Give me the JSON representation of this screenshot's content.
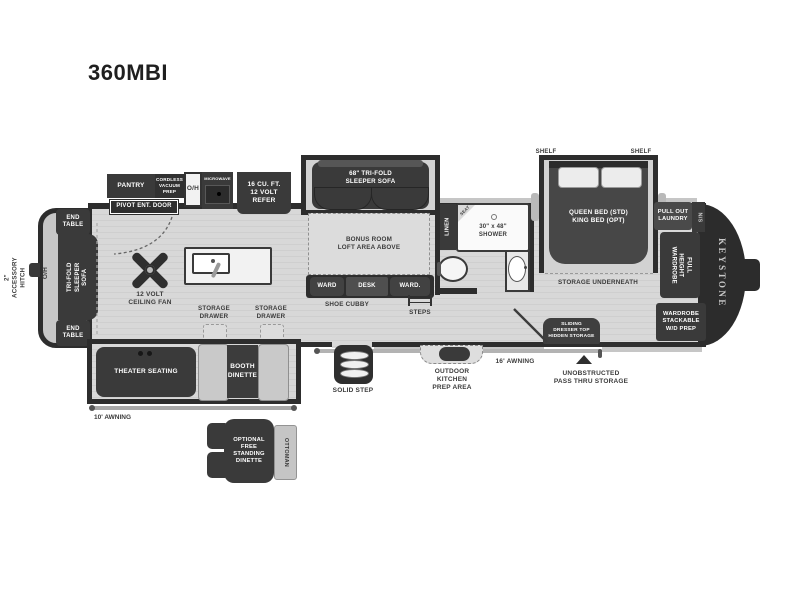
{
  "title": "360MBI",
  "brand": "KEYSTONE",
  "colors": {
    "dark_furniture": "#3a3a3a",
    "walls": "#2d2d2d",
    "floor": "#d8d8d8",
    "light_gray": "#c9c9c9",
    "white": "#ffffff",
    "label_text": "#3b3b3b"
  },
  "exterior": {
    "accessory_hitch": "2\" ACCESSORY HITCH",
    "awning_rear": "10' AWNING",
    "awning_front": "16' AWNING",
    "pass_thru": "UNOBSTRUCTED\nPASS THRU STORAGE",
    "outdoor_kitchen": "OUTDOOR\nKITCHEN\nPREP AREA",
    "solid_step": "SOLID STEP"
  },
  "rear": {
    "end_table": "END\nTABLE",
    "overhead": "O/H",
    "sofa": "TRI-FOLD\nSLEEPER SOFA"
  },
  "living": {
    "ceiling_fan": "12 VOLT\nCEILING FAN",
    "theater": "THEATER SEATING",
    "booth": "BOOTH\nDINETTE",
    "storage_drawer": "STORAGE\nDRAWER"
  },
  "kitchen": {
    "pantry": "PANTRY",
    "vacuum": "CORDLESS\nVACUUM\nPREP",
    "overhead": "O/H",
    "microwave": "MICROWAVE",
    "refer": "16 CU. FT.\n12 VOLT\nREFER",
    "entry_door": "PIVOT ENT. DOOR"
  },
  "bonus": {
    "sofa": "68\" TRI-FOLD\nSLEEPER SOFA",
    "loft": "BONUS ROOM\nLOFT AREA ABOVE",
    "ward_left": "WARD",
    "desk": "DESK",
    "ward_right": "WARD.",
    "shoe_cubby": "SHOE CUBBY",
    "steps": "STEPS"
  },
  "bath": {
    "linen": "LINEN",
    "seat": "SEAT",
    "shower": "30\" x 48\"\nSHOWER"
  },
  "bedroom": {
    "shelf": "SHELF",
    "bed": "QUEEN BED (STD)\nKING BED (OPT)",
    "storage": "STORAGE UNDERNEATH",
    "laundry": "PULL OUT\nLAUNDRY",
    "night_stand": "N/S",
    "wardrobe": "FULL HEIGHT\nWARDROBE",
    "wd_prep": "WARDROBE\nSTACKABLE\nW/D PREP",
    "dresser": "SLIDING\nDRESSER TOP\nHIDDEN STORAGE"
  },
  "optional_dinette": {
    "table": "OPTIONAL\nFREE\nSTANDING\nDINETTE",
    "ottoman": "OTTOMAN"
  }
}
